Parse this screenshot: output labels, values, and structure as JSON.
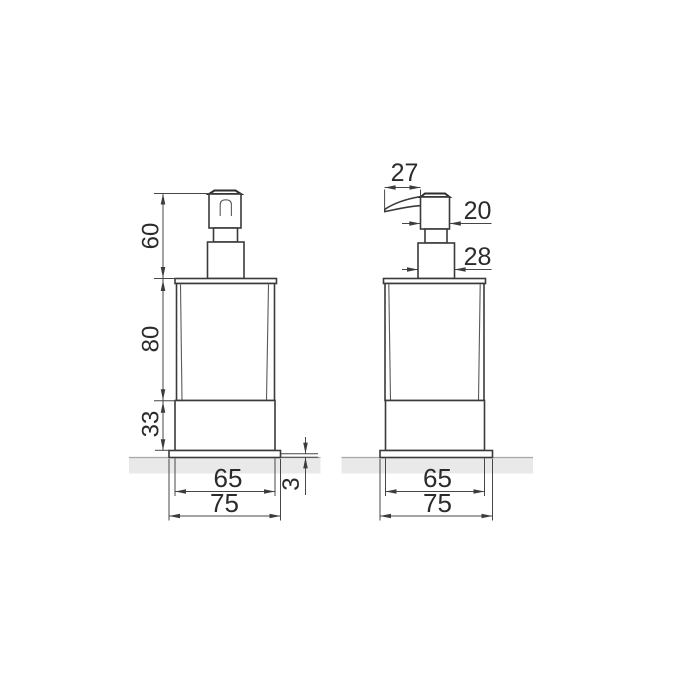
{
  "drawing": {
    "front_view": {
      "pump_height": "60",
      "body_height": "80",
      "base_height": "33",
      "plate_thickness": "3",
      "base_width": "65",
      "plate_width": "75"
    },
    "side_view": {
      "spout_reach": "27",
      "pump_width": "20",
      "collar_width": "28",
      "base_width": "65",
      "plate_width": "75"
    },
    "colors": {
      "line": "#3a3a3a",
      "dimension_line": "#474747",
      "text": "#2b2b2b",
      "ground": "#e9e9e9",
      "background": "#ffffff"
    }
  }
}
